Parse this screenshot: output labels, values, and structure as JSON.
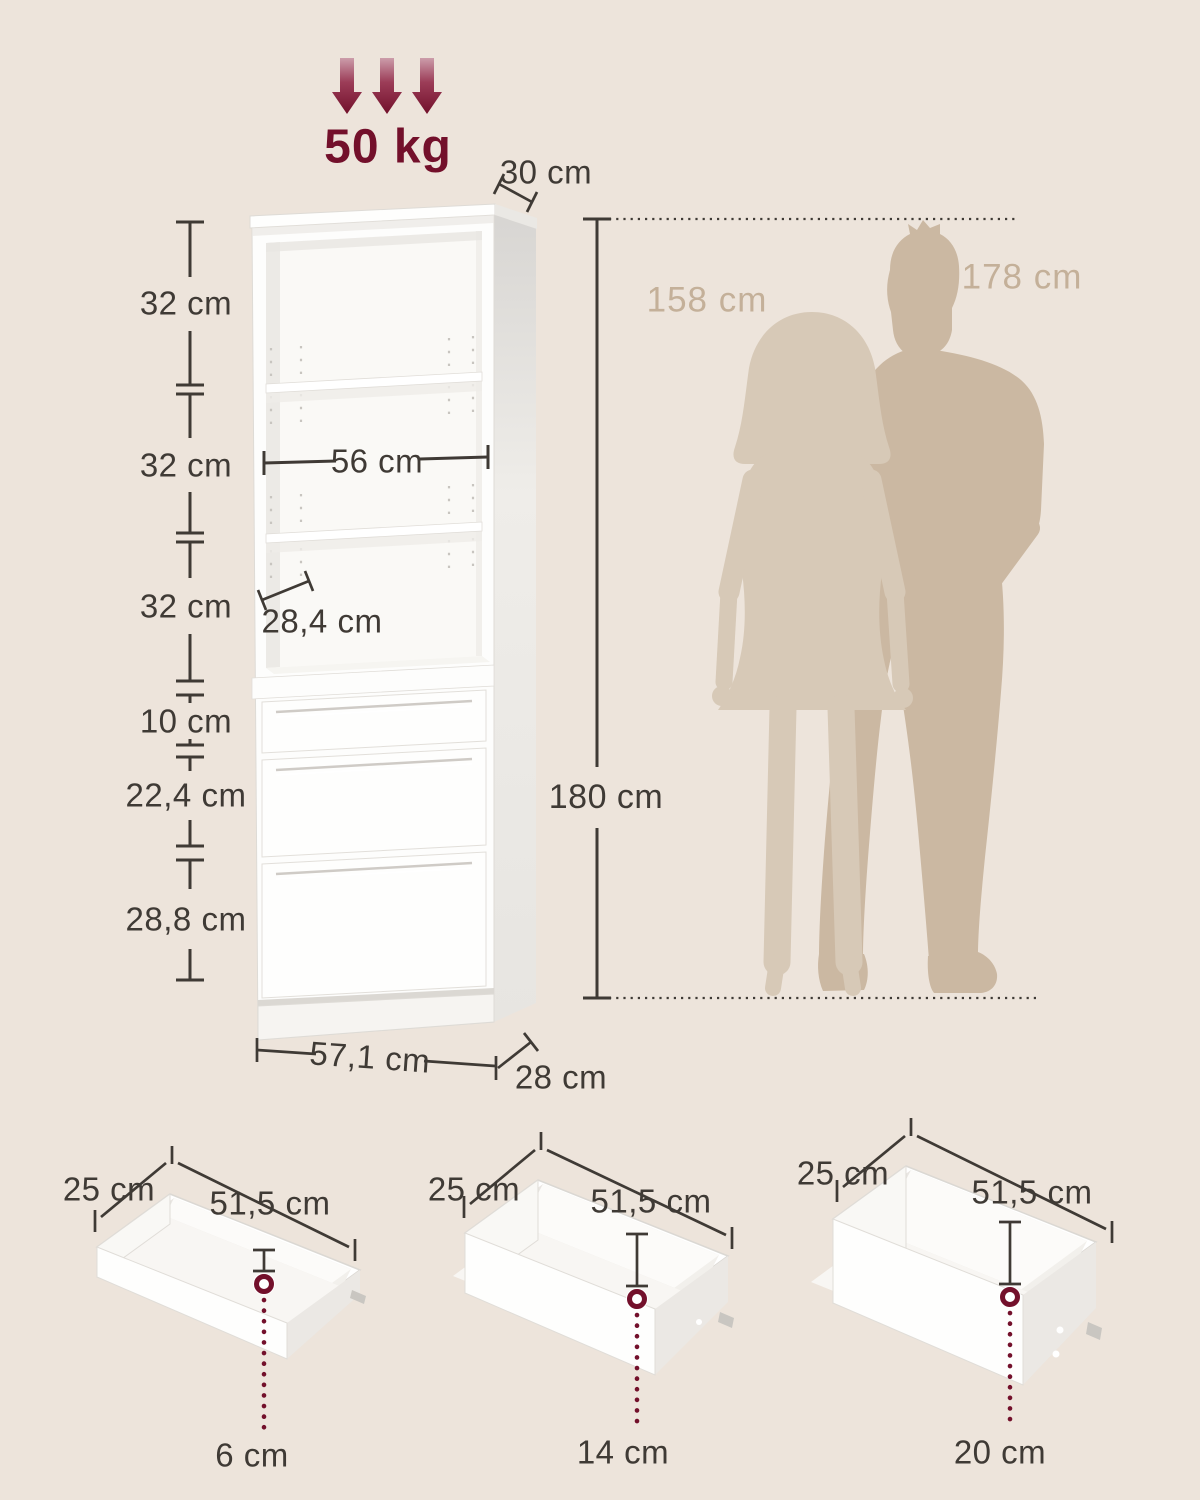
{
  "title": "Bookshelf with drawers - dimensions diagram",
  "load": {
    "value": "50 kg"
  },
  "cabinet": {
    "top_depth": "30 cm",
    "compartment_1": "32 cm",
    "compartment_2": "32 cm",
    "compartment_3": "32 cm",
    "drawer_front_small": "10 cm",
    "drawer_front_medium": "22,4 cm",
    "drawer_front_large": "28,8 cm",
    "inner_width": "56 cm",
    "inner_depth": "28,4 cm",
    "total_height": "180 cm",
    "total_width": "57,1 cm",
    "base_depth": "28 cm"
  },
  "people": {
    "woman_height": "158 cm",
    "man_height": "178 cm"
  },
  "drawers": [
    {
      "depth": "25 cm",
      "width": "51,5 cm",
      "inner_height": "6 cm"
    },
    {
      "depth": "25 cm",
      "width": "51,5 cm",
      "inner_height": "14 cm"
    },
    {
      "depth": "25 cm",
      "width": "51,5 cm",
      "inner_height": "20 cm"
    }
  ],
  "colors": {
    "background": "#EDE4DB",
    "accent_red": "#73102B",
    "text_dark": "#3F3A35",
    "text_tan": "#C4B099",
    "silhouette_man": "#CBB8A2",
    "silhouette_woman": "#D7C9B7"
  }
}
